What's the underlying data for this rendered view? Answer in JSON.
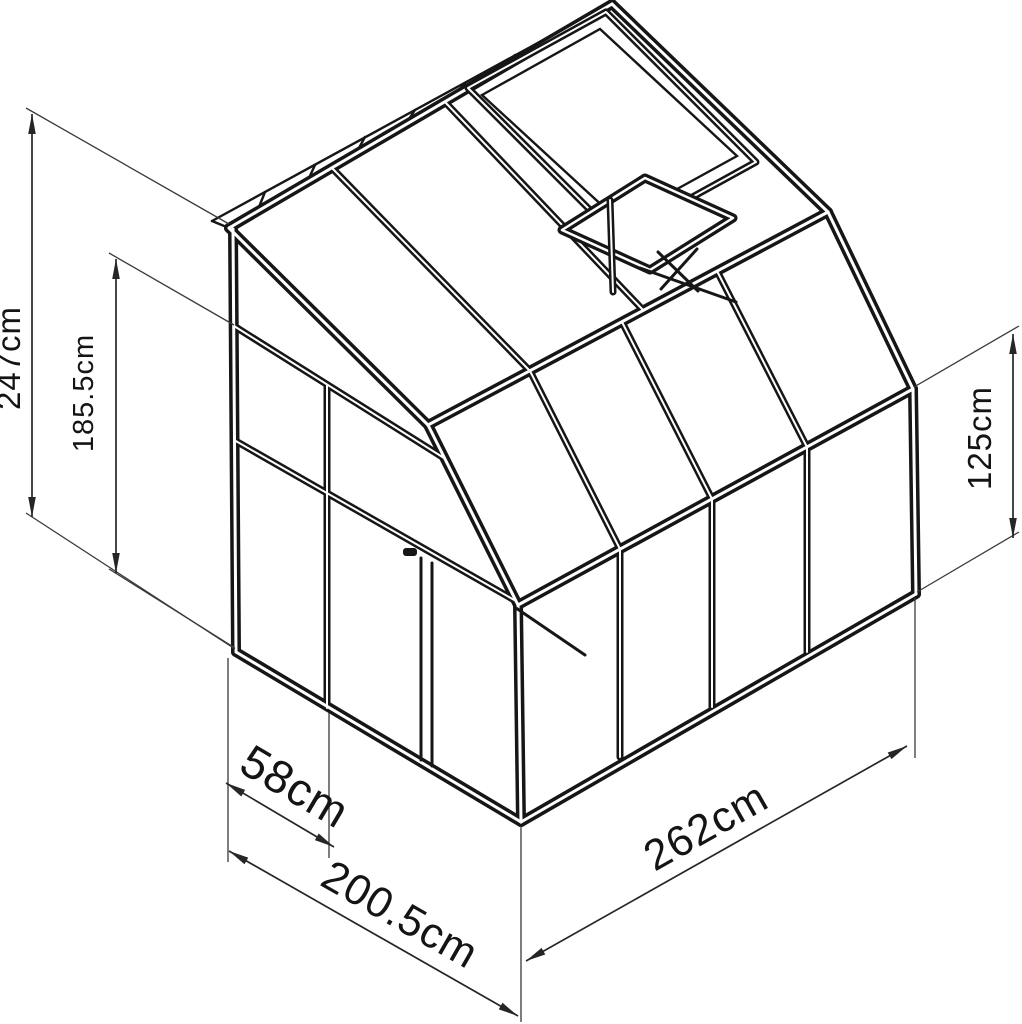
{
  "canvas": {
    "background": "#ffffff",
    "ink": "#161616",
    "dimension_line_color": "#262626"
  },
  "drawing": {
    "subject": "greenhouse-sun-room-frame-isometric",
    "unit": "cm"
  },
  "dimensions": {
    "total_height": "247cm",
    "wall_height": "185.5cm",
    "front_panel_height": "125cm",
    "door_panel_width": "58cm",
    "side_depth": "200.5cm",
    "front_width": "262cm"
  }
}
